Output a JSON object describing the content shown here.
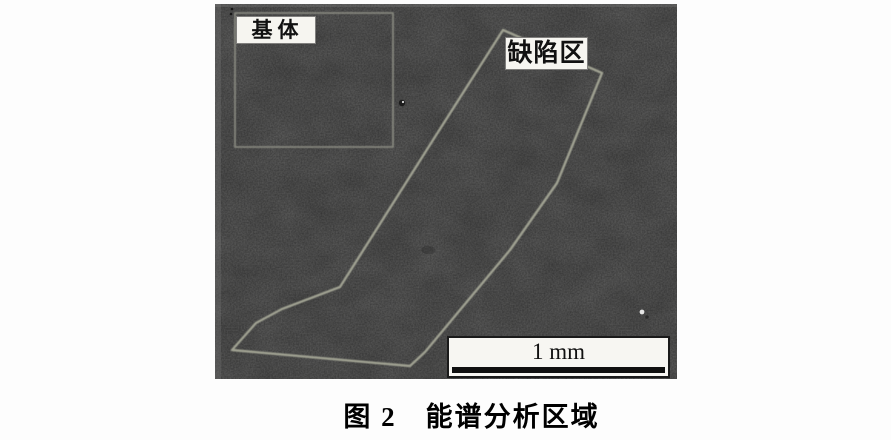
{
  "figure": {
    "micrograph": {
      "matrix_label": "基体",
      "defect_label": "缺陷区",
      "scale_bar_text": "1 mm",
      "defect_polygon_points": "288,26 387,69 342,179 295,246 210,348 195,362 17,346 41,319 67,305 125,283 218,136"
    },
    "caption": "图 2　能谱分析区域",
    "colors": {
      "micrograph_base": "#3c3c3c",
      "defect_outline": "#a6a897",
      "matrix_outline": "#8f9186",
      "label_background": "#f6f5f0",
      "label_text": "#111111",
      "scale_bar_line": "#101010",
      "page_background": "#fdfdfd"
    }
  }
}
